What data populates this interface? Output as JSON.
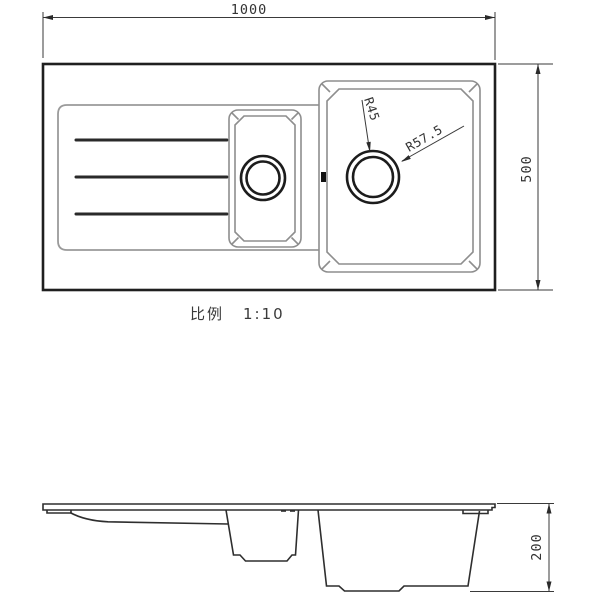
{
  "drawing": {
    "dim_width": "1000",
    "dim_height": "500",
    "dim_depth": "200",
    "radius_small": "R45",
    "radius_large": "R57.5",
    "scale_label": "比例",
    "scale_value": "1:10"
  },
  "colors": {
    "background": "#ffffff",
    "outline_dark": "#1f1f1f",
    "outline_gray": "#8e8e8e",
    "dimension_line": "#3a3a3a",
    "text": "#333333",
    "overflow_mark": "#111111"
  }
}
